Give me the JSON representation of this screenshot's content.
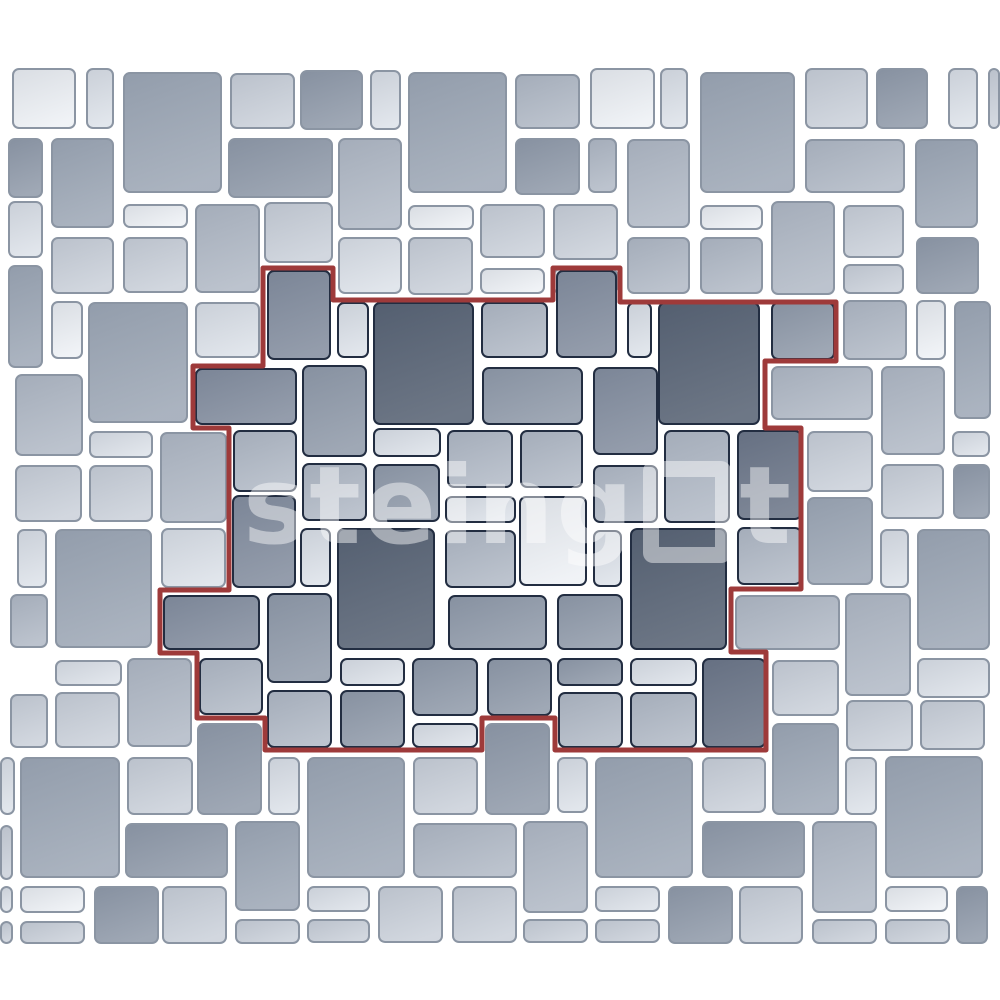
{
  "canvas": {
    "background": "#ffffff",
    "outer_border_color": "#8b95a3",
    "inner_border_color": "#222d41",
    "outline_color": "#9e3a3a",
    "outline_width": 5
  },
  "watermark": {
    "brand": "steingot",
    "text_before_square": "steing",
    "text_after_square": "t"
  },
  "palette": {
    "w": "#eef1f5",
    "l": "#dde2e9",
    "lm": "#ccd2db",
    "ml": "#b3bbc7",
    "m": "#9fa9b7",
    "m2": "#929cab",
    "md": "#858fa0",
    "dd": "#6d7789",
    "d": "#596475"
  },
  "outline_points": "263,268 333,268 333,300 553,300 553,268 620,268 620,302 836,302 836,361 765,361 765,428 801,428 801,589 731,589 731,652 766,652 766,750 555,750 555,718 482,718 482,750 265,750 265,718 197,718 197,653 160,653 160,590 229,590 229,428 193,428 193,366 263,366",
  "tiles": [
    [
      12,
      68,
      64,
      61,
      "w",
      "out"
    ],
    [
      86,
      68,
      28,
      61,
      "l",
      "out"
    ],
    [
      123,
      72,
      99,
      121,
      "m",
      "out"
    ],
    [
      230,
      73,
      65,
      56,
      "lm",
      "out"
    ],
    [
      300,
      70,
      63,
      60,
      "m2",
      "out"
    ],
    [
      370,
      70,
      31,
      60,
      "l",
      "out"
    ],
    [
      408,
      72,
      99,
      121,
      "m",
      "out"
    ],
    [
      515,
      74,
      65,
      55,
      "ml",
      "out"
    ],
    [
      590,
      68,
      65,
      61,
      "w",
      "out"
    ],
    [
      660,
      68,
      28,
      61,
      "l",
      "out"
    ],
    [
      700,
      72,
      95,
      121,
      "m",
      "out"
    ],
    [
      805,
      68,
      63,
      61,
      "lm",
      "out"
    ],
    [
      876,
      68,
      52,
      61,
      "m2",
      "out"
    ],
    [
      948,
      68,
      30,
      61,
      "l",
      "out"
    ],
    [
      988,
      68,
      12,
      61,
      "lm",
      "out"
    ],
    [
      8,
      138,
      35,
      60,
      "m2",
      "out"
    ],
    [
      51,
      138,
      63,
      90,
      "m",
      "out"
    ],
    [
      228,
      138,
      105,
      60,
      "m2",
      "out"
    ],
    [
      338,
      138,
      64,
      92,
      "ml",
      "out"
    ],
    [
      515,
      138,
      65,
      57,
      "m2",
      "out"
    ],
    [
      588,
      138,
      29,
      55,
      "ml",
      "out"
    ],
    [
      627,
      139,
      63,
      89,
      "ml",
      "out"
    ],
    [
      805,
      139,
      100,
      54,
      "ml",
      "out"
    ],
    [
      915,
      139,
      63,
      89,
      "m",
      "out"
    ],
    [
      8,
      201,
      35,
      57,
      "l",
      "out"
    ],
    [
      123,
      204,
      65,
      24,
      "w",
      "out"
    ],
    [
      195,
      204,
      65,
      89,
      "ml",
      "out"
    ],
    [
      264,
      202,
      69,
      61,
      "lm",
      "out"
    ],
    [
      408,
      205,
      66,
      25,
      "w",
      "out"
    ],
    [
      480,
      204,
      65,
      54,
      "lm",
      "out"
    ],
    [
      553,
      204,
      65,
      56,
      "lm",
      "out"
    ],
    [
      700,
      205,
      63,
      25,
      "w",
      "out"
    ],
    [
      771,
      201,
      64,
      94,
      "ml",
      "out"
    ],
    [
      843,
      205,
      61,
      53,
      "lm",
      "out"
    ],
    [
      51,
      237,
      63,
      57,
      "lm",
      "out"
    ],
    [
      123,
      237,
      65,
      56,
      "lm",
      "out"
    ],
    [
      338,
      237,
      64,
      57,
      "l",
      "out"
    ],
    [
      408,
      237,
      65,
      58,
      "lm",
      "out"
    ],
    [
      480,
      268,
      65,
      26,
      "w",
      "out"
    ],
    [
      553,
      268,
      65,
      26,
      "w",
      "out"
    ],
    [
      627,
      237,
      63,
      57,
      "ml",
      "out"
    ],
    [
      700,
      237,
      63,
      57,
      "ml",
      "out"
    ],
    [
      843,
      264,
      61,
      30,
      "lm",
      "out"
    ],
    [
      916,
      237,
      63,
      57,
      "m2",
      "out"
    ],
    [
      8,
      265,
      35,
      103,
      "m",
      "out"
    ],
    [
      51,
      301,
      32,
      58,
      "w",
      "out"
    ],
    [
      88,
      302,
      100,
      121,
      "m",
      "out"
    ],
    [
      195,
      302,
      65,
      56,
      "l",
      "out"
    ],
    [
      843,
      300,
      64,
      60,
      "ml",
      "out"
    ],
    [
      916,
      300,
      30,
      60,
      "w",
      "out"
    ],
    [
      954,
      301,
      37,
      118,
      "m",
      "out"
    ],
    [
      771,
      366,
      102,
      54,
      "ml",
      "out"
    ],
    [
      881,
      366,
      64,
      89,
      "ml",
      "out"
    ],
    [
      952,
      431,
      38,
      26,
      "l",
      "out"
    ],
    [
      807,
      431,
      66,
      61,
      "lm",
      "out"
    ],
    [
      881,
      464,
      63,
      55,
      "lm",
      "out"
    ],
    [
      953,
      464,
      37,
      55,
      "m2",
      "out"
    ],
    [
      807,
      497,
      66,
      88,
      "m",
      "out"
    ],
    [
      880,
      529,
      29,
      59,
      "l",
      "out"
    ],
    [
      917,
      529,
      73,
      121,
      "m",
      "out"
    ],
    [
      735,
      595,
      105,
      55,
      "ml",
      "out"
    ],
    [
      845,
      593,
      66,
      103,
      "ml",
      "out"
    ],
    [
      772,
      660,
      67,
      56,
      "lm",
      "out"
    ],
    [
      917,
      658,
      73,
      40,
      "l",
      "out"
    ],
    [
      846,
      700,
      67,
      51,
      "lm",
      "out"
    ],
    [
      920,
      700,
      65,
      50,
      "lm",
      "out"
    ],
    [
      772,
      723,
      67,
      92,
      "m",
      "out"
    ],
    [
      15,
      374,
      68,
      82,
      "ml",
      "out"
    ],
    [
      89,
      431,
      64,
      27,
      "l",
      "out"
    ],
    [
      15,
      465,
      67,
      57,
      "lm",
      "out"
    ],
    [
      89,
      465,
      64,
      57,
      "lm",
      "out"
    ],
    [
      160,
      432,
      67,
      91,
      "ml",
      "out"
    ],
    [
      17,
      529,
      30,
      59,
      "l",
      "out"
    ],
    [
      55,
      529,
      97,
      119,
      "m",
      "out"
    ],
    [
      161,
      528,
      65,
      60,
      "l",
      "out"
    ],
    [
      10,
      594,
      38,
      54,
      "ml",
      "out"
    ],
    [
      55,
      660,
      67,
      26,
      "l",
      "out"
    ],
    [
      127,
      658,
      65,
      89,
      "ml",
      "out"
    ],
    [
      10,
      694,
      38,
      54,
      "lm",
      "out"
    ],
    [
      55,
      692,
      65,
      56,
      "lm",
      "out"
    ],
    [
      0,
      757,
      15,
      58,
      "l",
      "out"
    ],
    [
      20,
      757,
      100,
      121,
      "m",
      "out"
    ],
    [
      127,
      757,
      66,
      58,
      "lm",
      "out"
    ],
    [
      197,
      723,
      65,
      92,
      "m2",
      "out"
    ],
    [
      268,
      757,
      32,
      58,
      "l",
      "out"
    ],
    [
      307,
      757,
      98,
      121,
      "m",
      "out"
    ],
    [
      0,
      825,
      13,
      55,
      "lm",
      "out"
    ],
    [
      125,
      823,
      103,
      55,
      "m2",
      "out"
    ],
    [
      235,
      821,
      65,
      90,
      "m",
      "out"
    ],
    [
      20,
      886,
      65,
      27,
      "w",
      "out"
    ],
    [
      94,
      886,
      65,
      58,
      "m2",
      "out"
    ],
    [
      162,
      886,
      65,
      58,
      "lm",
      "out"
    ],
    [
      0,
      886,
      13,
      27,
      "l",
      "out"
    ],
    [
      20,
      921,
      65,
      23,
      "lm",
      "out"
    ],
    [
      0,
      921,
      13,
      23,
      "lm",
      "out"
    ],
    [
      235,
      919,
      65,
      25,
      "lm",
      "out"
    ],
    [
      307,
      886,
      63,
      26,
      "l",
      "out"
    ],
    [
      307,
      919,
      63,
      24,
      "lm",
      "out"
    ],
    [
      378,
      886,
      65,
      57,
      "lm",
      "out"
    ],
    [
      452,
      886,
      65,
      57,
      "lm",
      "out"
    ],
    [
      413,
      757,
      65,
      58,
      "lm",
      "out"
    ],
    [
      485,
      723,
      65,
      92,
      "m2",
      "out"
    ],
    [
      557,
      757,
      31,
      56,
      "l",
      "out"
    ],
    [
      595,
      757,
      98,
      121,
      "m",
      "out"
    ],
    [
      413,
      823,
      104,
      55,
      "ml",
      "out"
    ],
    [
      523,
      821,
      65,
      92,
      "ml",
      "out"
    ],
    [
      523,
      919,
      65,
      24,
      "lm",
      "out"
    ],
    [
      595,
      886,
      65,
      26,
      "l",
      "out"
    ],
    [
      595,
      919,
      65,
      24,
      "lm",
      "out"
    ],
    [
      668,
      886,
      65,
      58,
      "m2",
      "out"
    ],
    [
      739,
      886,
      64,
      58,
      "lm",
      "out"
    ],
    [
      702,
      757,
      64,
      56,
      "lm",
      "out"
    ],
    [
      702,
      821,
      103,
      57,
      "m2",
      "out"
    ],
    [
      812,
      821,
      65,
      92,
      "ml",
      "out"
    ],
    [
      885,
      756,
      98,
      122,
      "m",
      "out"
    ],
    [
      845,
      757,
      32,
      58,
      "l",
      "out"
    ],
    [
      885,
      886,
      63,
      26,
      "w",
      "out"
    ],
    [
      812,
      919,
      65,
      25,
      "lm",
      "out"
    ],
    [
      885,
      919,
      65,
      25,
      "lm",
      "out"
    ],
    [
      956,
      886,
      32,
      58,
      "m2",
      "out"
    ],
    [
      267,
      270,
      64,
      90,
      "md",
      "in"
    ],
    [
      337,
      302,
      32,
      56,
      "l",
      "in"
    ],
    [
      373,
      302,
      101,
      123,
      "d",
      "in"
    ],
    [
      481,
      302,
      67,
      56,
      "ml",
      "in"
    ],
    [
      556,
      270,
      61,
      88,
      "md",
      "in"
    ],
    [
      627,
      302,
      25,
      56,
      "l",
      "in"
    ],
    [
      658,
      302,
      102,
      123,
      "d",
      "in"
    ],
    [
      771,
      302,
      64,
      58,
      "m2",
      "in"
    ],
    [
      195,
      368,
      102,
      57,
      "md",
      "in"
    ],
    [
      302,
      365,
      65,
      92,
      "m2",
      "in"
    ],
    [
      482,
      367,
      101,
      58,
      "m2",
      "in"
    ],
    [
      593,
      367,
      65,
      88,
      "md",
      "in"
    ],
    [
      664,
      430,
      66,
      93,
      "ml",
      "in"
    ],
    [
      737,
      430,
      65,
      90,
      "dd",
      "in"
    ],
    [
      233,
      430,
      64,
      62,
      "ml",
      "in"
    ],
    [
      373,
      428,
      68,
      29,
      "l",
      "in"
    ],
    [
      447,
      430,
      66,
      58,
      "ml",
      "in"
    ],
    [
      520,
      430,
      63,
      58,
      "ml",
      "in"
    ],
    [
      302,
      463,
      65,
      58,
      "ml",
      "in"
    ],
    [
      373,
      464,
      67,
      58,
      "m2",
      "in"
    ],
    [
      445,
      496,
      71,
      27,
      "l",
      "in"
    ],
    [
      519,
      496,
      68,
      90,
      "w",
      "in"
    ],
    [
      593,
      465,
      65,
      58,
      "ml",
      "in"
    ],
    [
      232,
      495,
      64,
      93,
      "md",
      "in"
    ],
    [
      300,
      528,
      31,
      59,
      "l",
      "in"
    ],
    [
      337,
      528,
      98,
      122,
      "d",
      "in"
    ],
    [
      445,
      530,
      71,
      58,
      "ml",
      "in"
    ],
    [
      593,
      530,
      29,
      57,
      "l",
      "in"
    ],
    [
      630,
      528,
      97,
      122,
      "d",
      "in"
    ],
    [
      737,
      527,
      65,
      58,
      "ml",
      "in"
    ],
    [
      163,
      595,
      97,
      55,
      "md",
      "in"
    ],
    [
      267,
      593,
      65,
      90,
      "m2",
      "in"
    ],
    [
      448,
      595,
      99,
      55,
      "m2",
      "in"
    ],
    [
      557,
      594,
      66,
      56,
      "m2",
      "in"
    ],
    [
      199,
      658,
      64,
      57,
      "ml",
      "in"
    ],
    [
      340,
      658,
      65,
      28,
      "l",
      "in"
    ],
    [
      412,
      658,
      66,
      58,
      "m2",
      "in"
    ],
    [
      487,
      658,
      65,
      58,
      "m2",
      "in"
    ],
    [
      557,
      658,
      66,
      28,
      "m2",
      "in"
    ],
    [
      630,
      658,
      67,
      28,
      "l",
      "in"
    ],
    [
      702,
      658,
      64,
      90,
      "dd",
      "in"
    ],
    [
      267,
      690,
      65,
      58,
      "ml",
      "in"
    ],
    [
      340,
      690,
      65,
      58,
      "m2",
      "in"
    ],
    [
      412,
      723,
      66,
      25,
      "l",
      "in"
    ],
    [
      558,
      692,
      65,
      56,
      "ml",
      "in"
    ],
    [
      630,
      692,
      67,
      56,
      "ml",
      "in"
    ]
  ]
}
